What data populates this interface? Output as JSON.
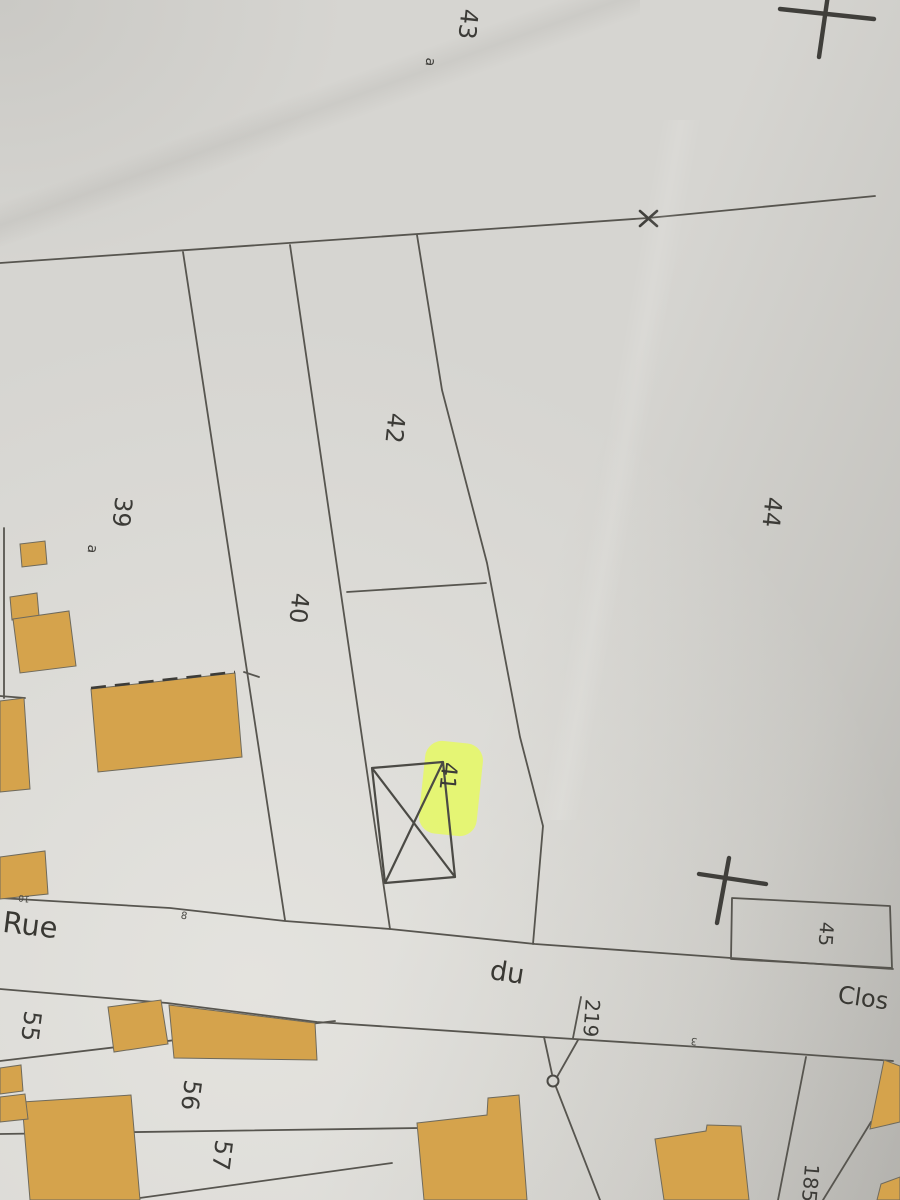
{
  "map": {
    "title": "Cadastral plan photo — Rue du Clos",
    "street_name": {
      "rue": "Rue",
      "du": "du",
      "clos": "Clos"
    },
    "parcels": {
      "p43": "43",
      "p43a": "a",
      "p39": "39",
      "p39a": "a",
      "p42": "42",
      "p40": "40",
      "p44": "44",
      "p41": "41",
      "p45": "45",
      "p55": "55",
      "p56": "56",
      "p57": "57",
      "p219": "219",
      "p185": "185"
    },
    "small_marks": {
      "m10": "10",
      "m8": "8",
      "m3": "3"
    },
    "highlighted_parcel": "41",
    "colors": {
      "paper": "#d6d5d1",
      "line": "#57554f",
      "building": "#d5a34c",
      "bstroke": "#6f6a5c",
      "text": "#3c3b37",
      "cross": "#403f3b",
      "highlight": "#e6fa5e"
    }
  }
}
